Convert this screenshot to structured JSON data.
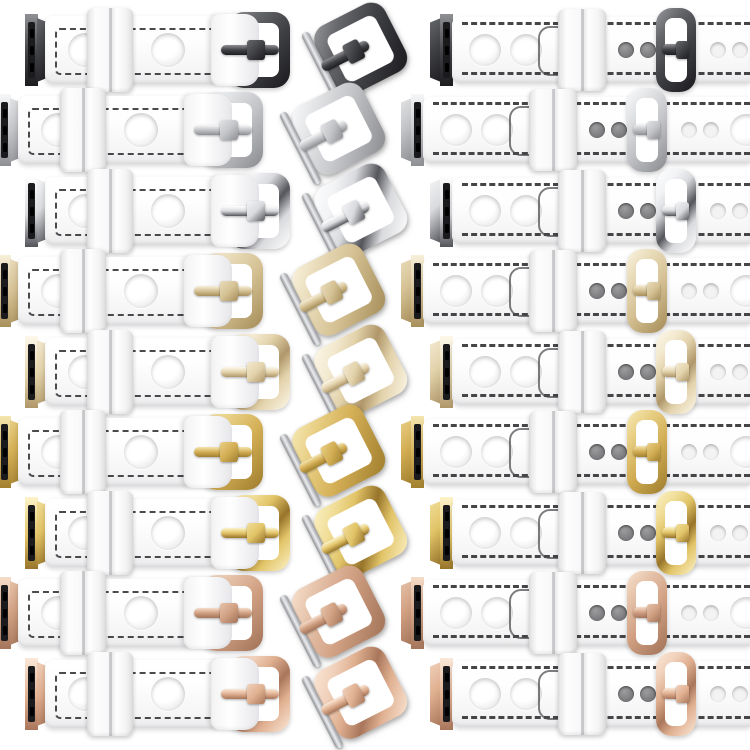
{
  "canvas": {
    "width": 750,
    "height": 750,
    "background": "#ffffff"
  },
  "image_description": "Product collage: white leather rally-style watch straps with round perforations for Apple Watch, shown in nine metal hardware variants; each row shows the buckle-side short strap with watch adapter, a loose pin buckle, and a fastened long strap with adjustment holes",
  "leather": {
    "base": "#ffffff",
    "shade": "#e9e9eb",
    "stitch": "#323235"
  },
  "steel_pin": {
    "light": "#edeef1",
    "base": "#b9babd",
    "dark": "#8d8e92"
  },
  "variants": [
    {
      "label": "Black",
      "finish": "matte",
      "metal": {
        "hi": "#8f9093",
        "light": "#66676b",
        "base": "#414246",
        "dark": "#1d1d20"
      }
    },
    {
      "label": "Silver matte",
      "finish": "matte",
      "metal": {
        "hi": "#f6f7f9",
        "light": "#e2e3e5",
        "base": "#c3c4c7",
        "dark": "#8e8f93"
      }
    },
    {
      "label": "Silver polished",
      "finish": "polished",
      "metal": {
        "hi": "#ffffff",
        "light": "#f2f3f5",
        "base": "#d9dadd",
        "dark": "#54555b"
      }
    },
    {
      "label": "Champagne gold matte",
      "finish": "matte",
      "metal": {
        "hi": "#f7efd9",
        "light": "#e9dcba",
        "base": "#d5c194",
        "dark": "#a8905c"
      }
    },
    {
      "label": "Champagne gold polished",
      "finish": "polished",
      "metal": {
        "hi": "#fdf8ea",
        "light": "#f3e9cf",
        "base": "#e3d3ac",
        "dark": "#b0976a"
      }
    },
    {
      "label": "Yellow gold matte",
      "finish": "matte",
      "metal": {
        "hi": "#f4e5ae",
        "light": "#e8cf84",
        "base": "#d3ae55",
        "dark": "#a1802f"
      }
    },
    {
      "label": "Yellow gold polished",
      "finish": "polished",
      "metal": {
        "hi": "#fcf3c8",
        "light": "#f0dd97",
        "base": "#e2c468",
        "dark": "#97742a"
      }
    },
    {
      "label": "Rose gold matte",
      "finish": "matte",
      "metal": {
        "hi": "#f5dcc8",
        "light": "#e5c2a9",
        "base": "#d1a083",
        "dark": "#a4755a"
      }
    },
    {
      "label": "Rose gold polished",
      "finish": "polished",
      "metal": {
        "hi": "#fbe8d8",
        "light": "#f0d0ba",
        "base": "#e0b091",
        "dark": "#a9765b"
      }
    }
  ],
  "layout": {
    "row_centers_y": [
      50,
      130,
      211,
      291,
      372,
      452,
      533,
      613,
      694
    ],
    "odd_row": {
      "left_strap_x": 25,
      "mid_buckle_cx": 358,
      "right_strap_x": 430
    },
    "even_row": {
      "left_strap_x": -2,
      "mid_buckle_cx": 336,
      "right_strap_x": 401
    }
  }
}
